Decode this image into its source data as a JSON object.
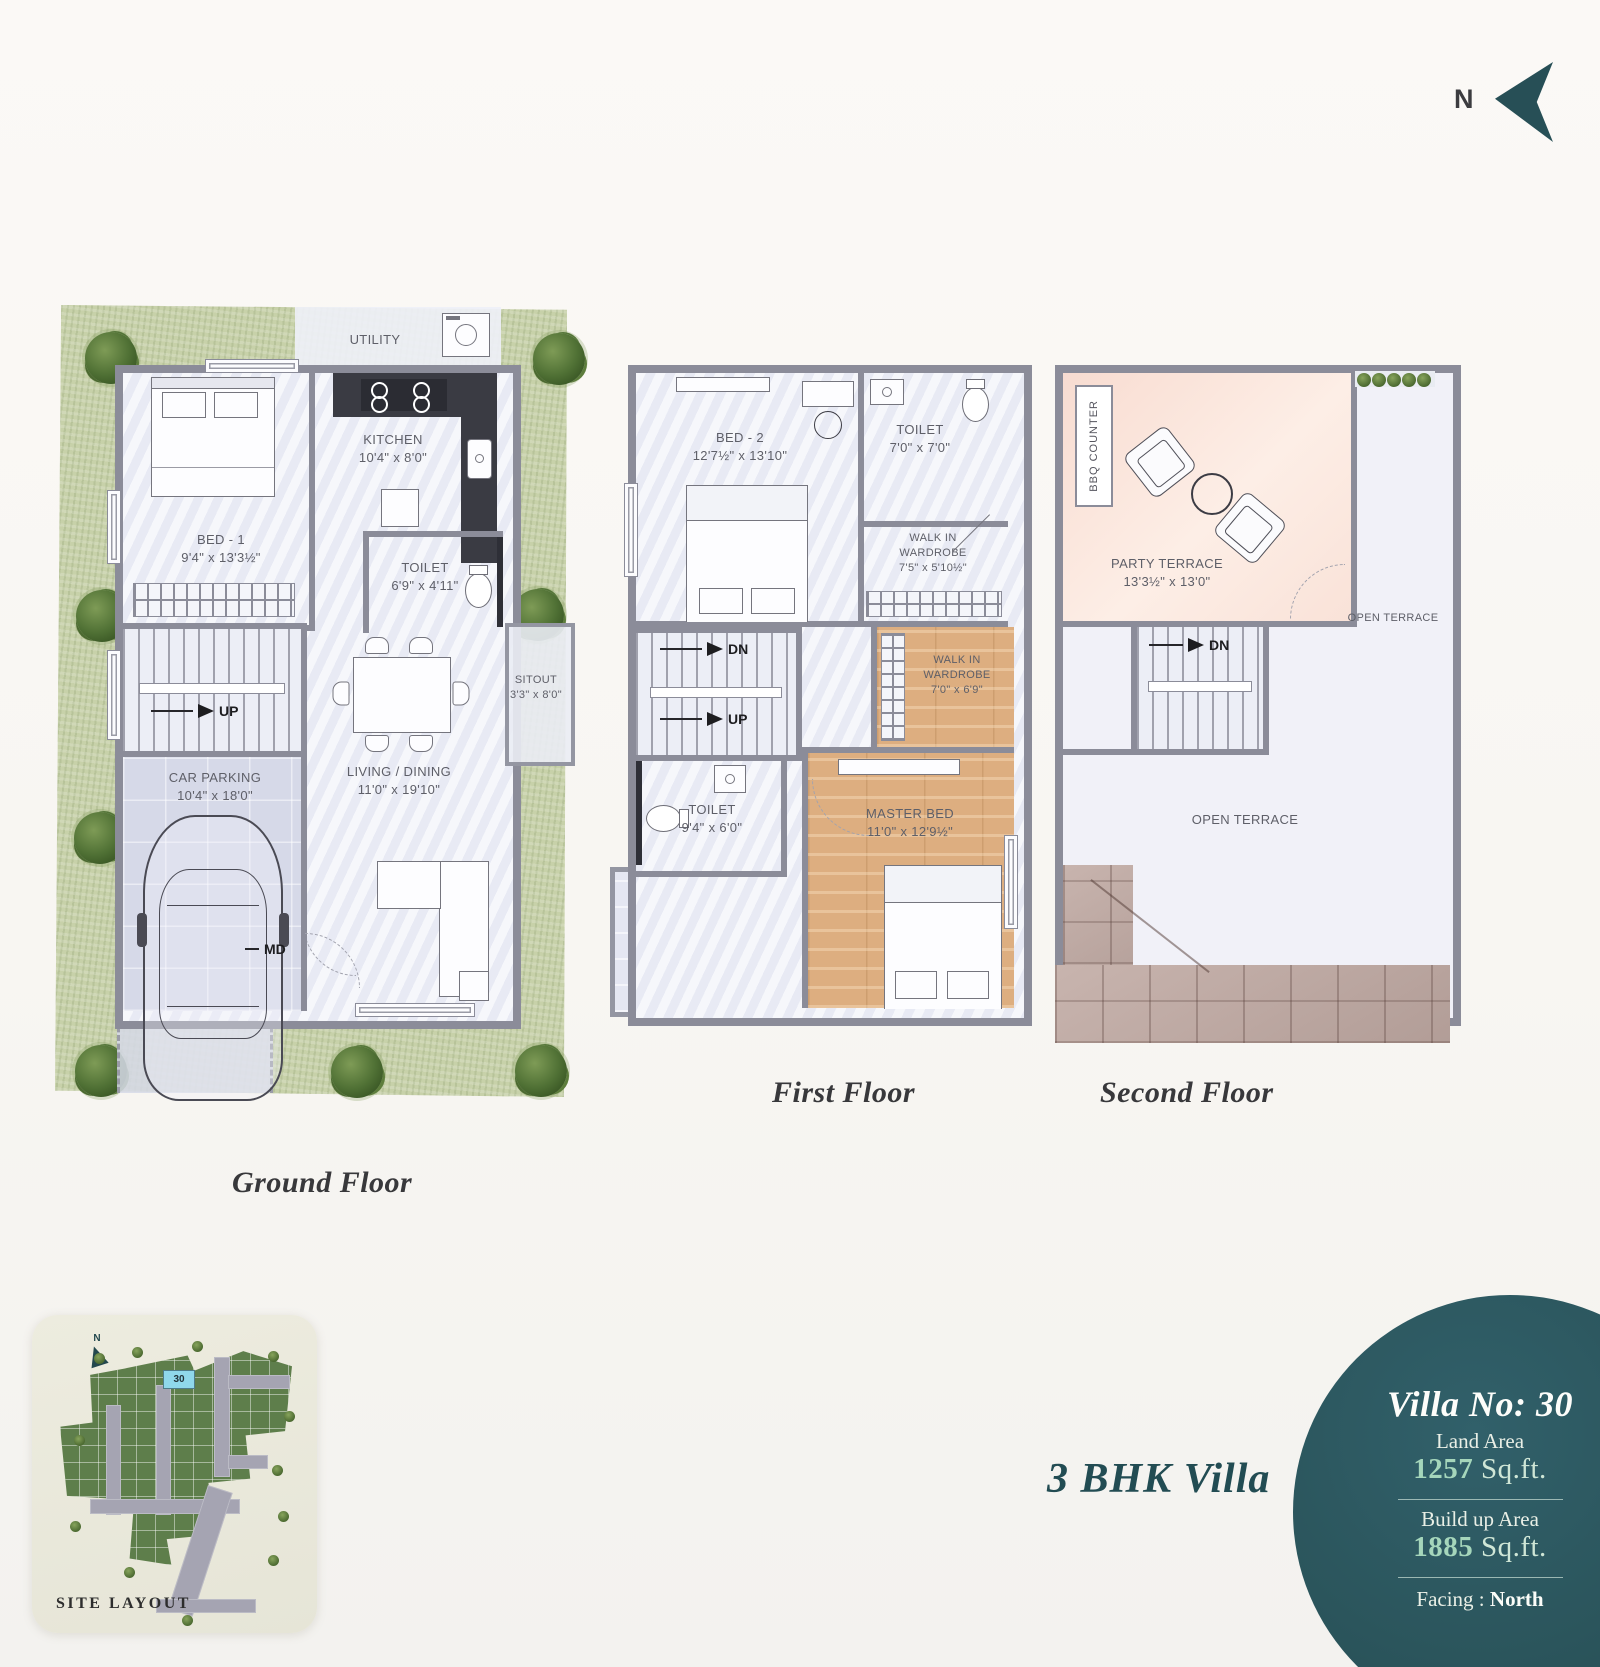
{
  "header": {
    "north_label": "N"
  },
  "floors": {
    "ground": {
      "title": "Ground Floor",
      "utility": {
        "name": "UTILITY"
      },
      "kitchen": {
        "name": "KITCHEN",
        "dim": "10'4\" x 8'0\""
      },
      "bed1": {
        "name": "BED - 1",
        "dim": "9'4\" x 13'3½\""
      },
      "toilet": {
        "name": "TOILET",
        "dim": "6'9\" x 4'11\""
      },
      "sitout": {
        "name": "SITOUT",
        "dim": "3'3\" x 8'0\""
      },
      "living": {
        "name": "LIVING / DINING",
        "dim": "11'0\" x 19'10\""
      },
      "parking": {
        "name": "CAR PARKING",
        "dim": "10'4\" x 18'0\""
      },
      "up_label": "UP",
      "md_label": "MD"
    },
    "first": {
      "title": "First Floor",
      "bed2": {
        "name": "BED - 2",
        "dim": "12'7½\" x 13'10\""
      },
      "toilet_top": {
        "name": "TOILET",
        "dim": "7'0\" x 7'0\""
      },
      "wardrobe_top": {
        "line1": "WALK IN",
        "line2": "WARDROBE",
        "dim": "7'5\" x 5'10½\""
      },
      "wardrobe_master": {
        "line1": "WALK IN",
        "line2": "WARDROBE",
        "dim": "7'0\" x 6'9\""
      },
      "toilet_master": {
        "name": "TOILET",
        "dim": "9'4\" x 6'0\""
      },
      "master": {
        "name": "MASTER BED",
        "dim": "11'0\" x 12'9½\""
      },
      "deck": {
        "name": "DECK",
        "dim": "10'0\" x 6'9\""
      },
      "dn_label": "DN",
      "up_label": "UP"
    },
    "second": {
      "title": "Second Floor",
      "bbq": "BBQ COUNTER",
      "party": {
        "name": "PARTY TERRACE",
        "dim": "13'3½\" x 13'0\""
      },
      "open_terrace": "OPEN TERRACE",
      "dn_label": "DN"
    }
  },
  "site": {
    "title": "SITE LAYOUT",
    "plot": "30",
    "north_label": "N"
  },
  "badge": {
    "villa_no": "Villa No: 30",
    "land_label": "Land Area",
    "land_value": "1257",
    "land_unit": "Sq.ft.",
    "build_label": "Build up Area",
    "build_value": "1885",
    "build_unit": "Sq.ft.",
    "facing_label": "Facing :",
    "facing_value": "North"
  },
  "caption": "3 BHK Villa",
  "colors": {
    "teal": "#2b555c",
    "pale_green": "#a5d6bb",
    "wall_gray": "#8b8c99",
    "wood": "#ddae80",
    "terrace_pink": "#f9e2d8",
    "grass": "#c7d1aa",
    "roof": "#bca7a1",
    "plot_highlight": "#8fd8ea"
  }
}
